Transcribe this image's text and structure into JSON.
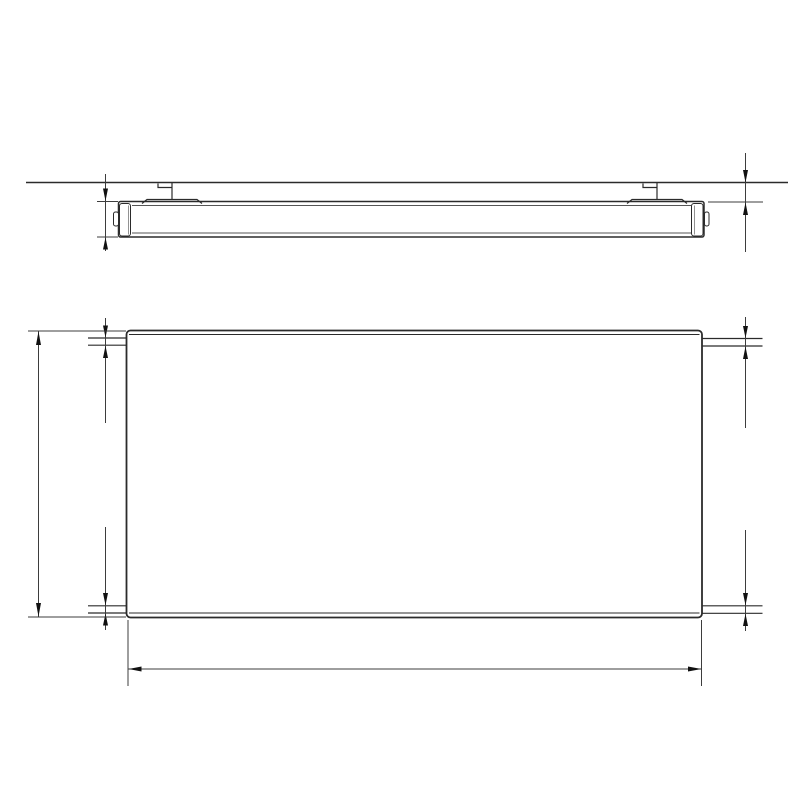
{
  "diagram": {
    "kind": "radiator-technical-dimension-drawing",
    "labels": {
      "depth": "73",
      "wall_clearance": "35",
      "height": "Y",
      "width": "X",
      "conn_top_left": "G1/2",
      "conn_top_right": "G1/2",
      "conn_bottom_left": "G1/2",
      "conn_bottom_right": "G1/2"
    },
    "side_view": {
      "wall_hatch_count": 8
    },
    "front_view": {
      "fin_count": 33
    },
    "colors": {
      "line": "#2b2b2b",
      "dim_line": "#3d3d3d",
      "fin_outer": "#6e6e6e",
      "fin_inner": "#a8a8a8",
      "detail": "#555555",
      "text": "#111111",
      "background": "#ffffff"
    }
  }
}
